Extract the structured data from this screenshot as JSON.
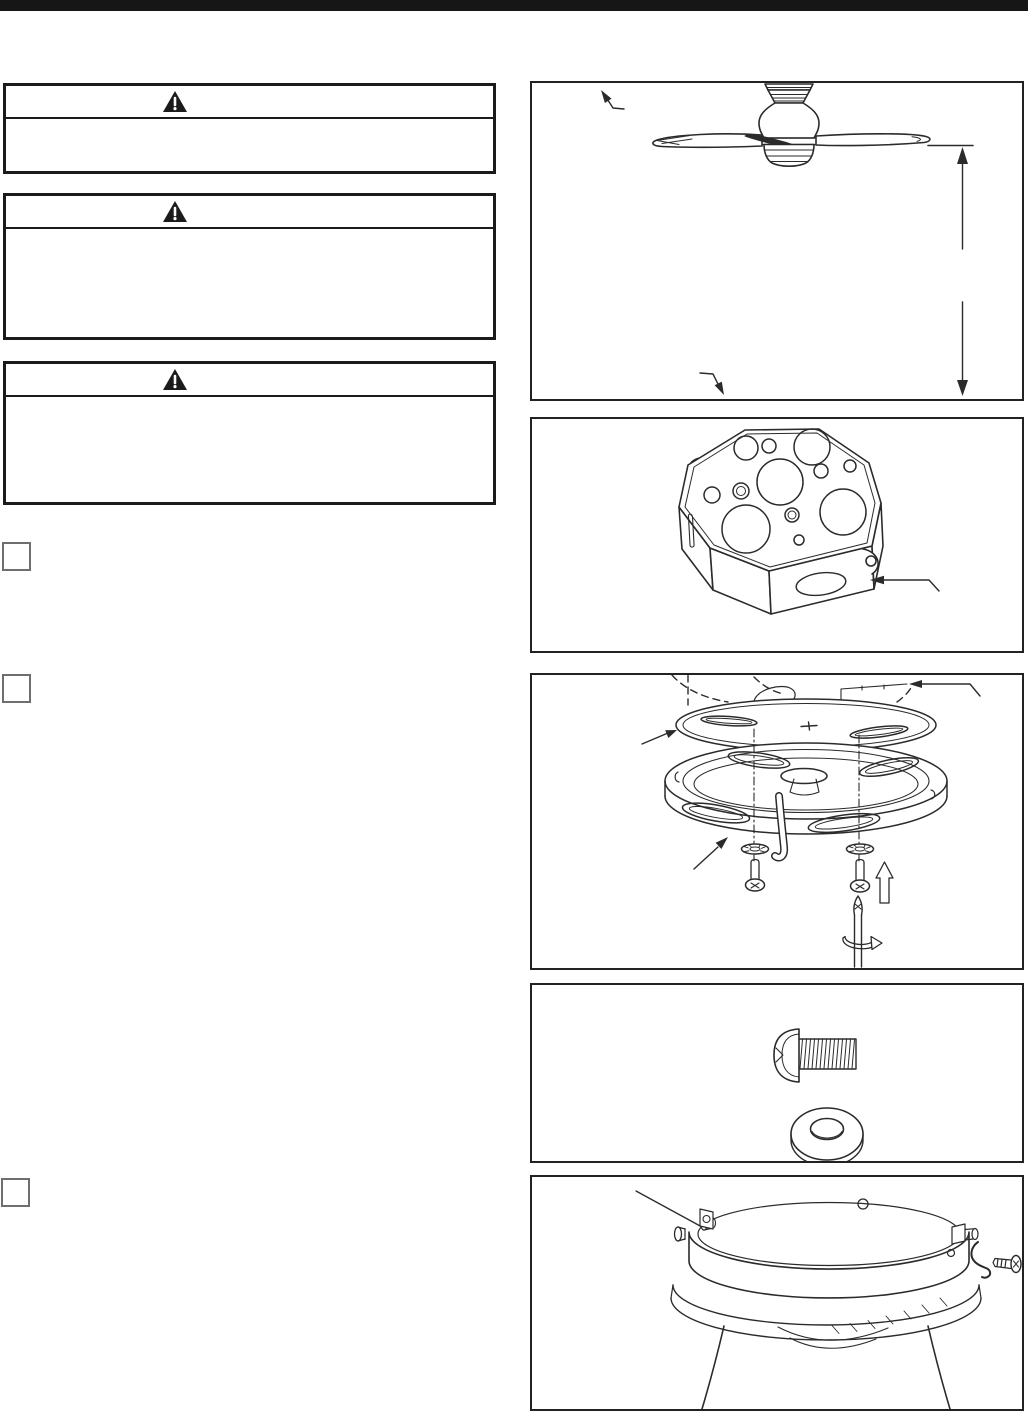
{
  "page": {
    "background": "#ffffff",
    "top_bar_color": "#161616",
    "ink_color": "#2b2b2b",
    "border_color": "#1b1b1b"
  },
  "warnings": [
    {
      "icon": "warning-triangle-icon",
      "header_text": "",
      "body_text": ""
    },
    {
      "icon": "warning-triangle-icon",
      "header_text": "",
      "body_text": ""
    },
    {
      "icon": "warning-triangle-icon",
      "header_text": "",
      "body_text": ""
    }
  ],
  "steps": [
    {
      "marker": "step-checkbox",
      "label": ""
    },
    {
      "marker": "step-checkbox",
      "label": ""
    },
    {
      "marker": "step-checkbox",
      "label": ""
    }
  ],
  "figures": [
    {
      "id": "fan-mounting-height",
      "depicts": "ceiling-fan-side-view-with-floor-clearance-dimension-arrow-and-two-callout-arrows"
    },
    {
      "id": "outlet-box",
      "depicts": "octagonal-metal-ceiling-outlet-box-with-knockouts-and-callout-arrow"
    },
    {
      "id": "mounting-bracket",
      "depicts": "mounting-bracket-and-canopy-ring-with-lock-washers-screws-screwdriver-and-rotation-arrow"
    },
    {
      "id": "screw-and-washer",
      "depicts": "truss-head-machine-screw-and-flat-washer"
    },
    {
      "id": "mounting-ring",
      "depicts": "mounting-ring-seated-on-motor-housing-with-side-screw-and-spring-clip"
    }
  ]
}
